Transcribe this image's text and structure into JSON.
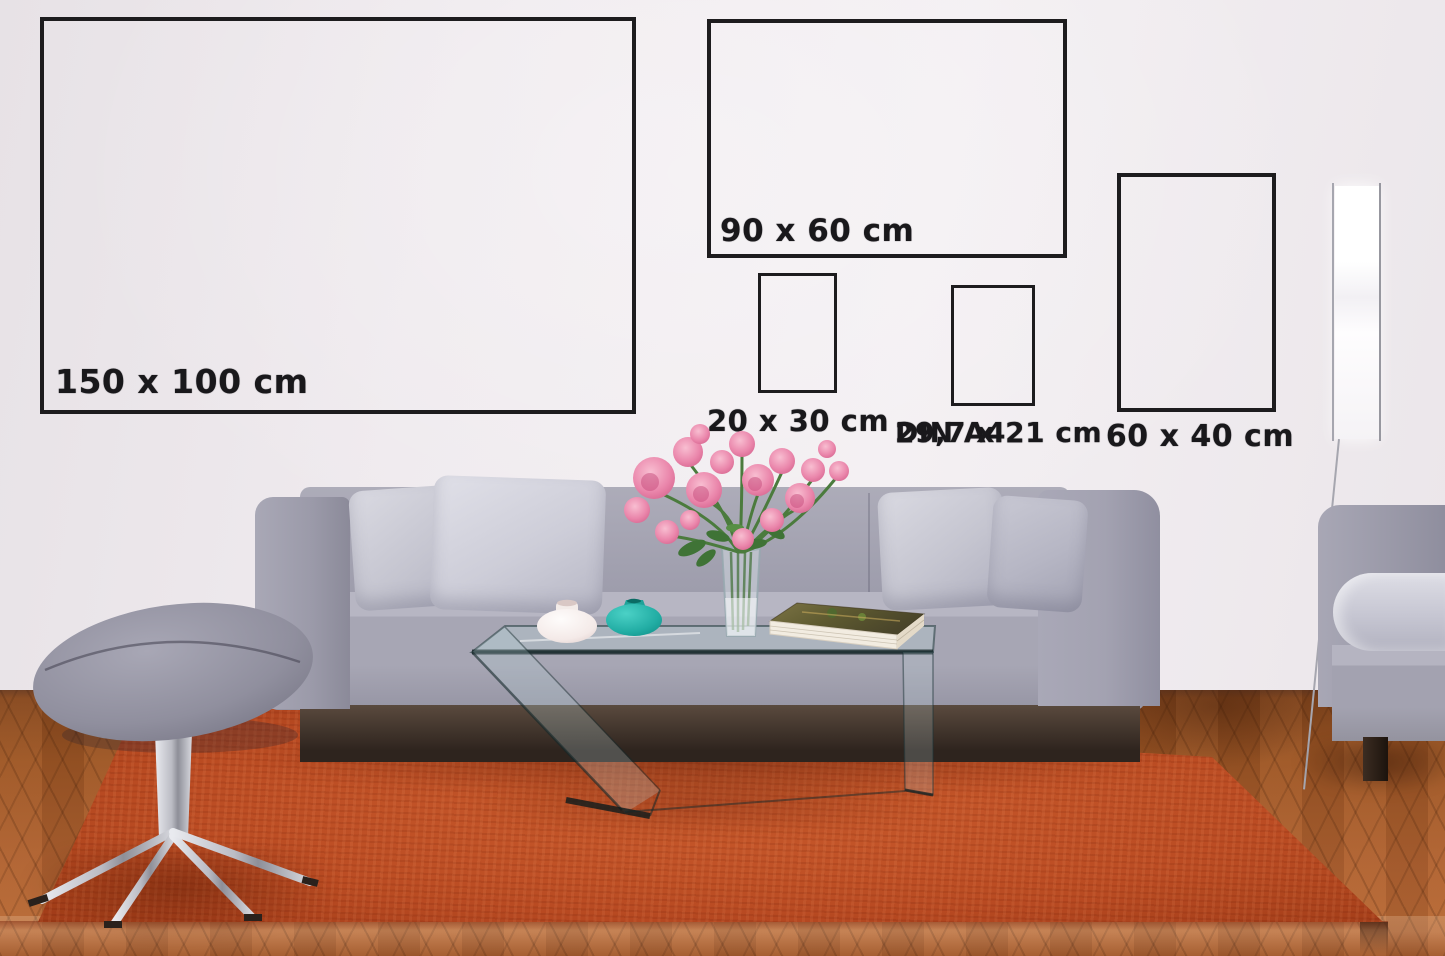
{
  "scene_type": "living-room poster size mockup",
  "size_guide": {
    "frames": [
      {
        "name": "150x100",
        "label": "150 x 100 cm"
      },
      {
        "name": "90x60",
        "label": "90 x 60 cm"
      },
      {
        "name": "20x30",
        "label": "20 x 30 cm"
      },
      {
        "name": "din-a4",
        "line1": "DIN A4",
        "line2": "29,7 x 21 cm"
      },
      {
        "name": "60x40",
        "label": "60 x 40 cm"
      }
    ]
  },
  "colors": {
    "frame_border": "#1d1c1e",
    "label_text": "#19181b",
    "wall": "#efeaee",
    "rug": "#bb4c23",
    "wood_floor": "#9b5526",
    "sofa_gray": "#a3a2b1",
    "pillow_gray": "#c6c6d1",
    "teal_vase": "#2bb3a8",
    "white_vase": "#f7f2f1",
    "flower_pink": "#e87ca3",
    "leaf_green": "#4b7b3d",
    "lamp_white": "#fdfcfd"
  }
}
